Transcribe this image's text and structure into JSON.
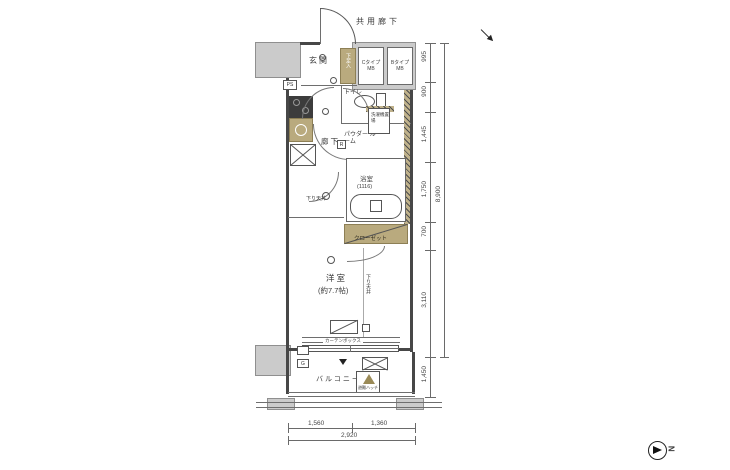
{
  "plan": {
    "labels": {
      "common_corridor": "共用廊下",
      "entrance": "玄関",
      "shoe_cabinet": "下足入",
      "mb_left_line1": "Cタイプ",
      "mb_left_line2": "MB",
      "mb_right_line1": "Bタイプ",
      "mb_right_line2": "MB",
      "toilet": "トイレ",
      "hallway": "廊下",
      "powder_room": "パウダー ルーム",
      "washer_space": "洗濯機置場",
      "bathroom": "浴室",
      "bathroom_module": "(1116)",
      "closet": "クローゼット",
      "western_room": "洋室",
      "western_room_size": "(約7.7帖)",
      "lowered_ceiling_left": "下り天井",
      "lowered_ceiling_right": "下り天井",
      "curtain_box": "カーテンボックス",
      "balcony": "バルコニー",
      "evacuation_hatch": "避難ハッチ",
      "badge_ps": "PS",
      "badge_r": "R",
      "badge_g": "G",
      "compass_north": "N"
    },
    "dims": {
      "right": [
        "995",
        "900",
        "1,445",
        "1,750",
        "700",
        "3,110",
        "1,450"
      ],
      "right_total": "8,900",
      "bottom": [
        "1,560",
        "1,360"
      ],
      "bottom_total": "2,920"
    },
    "colors": {
      "wall_fill": "#cbcbcb",
      "fixture_tan": "#b9aa7e",
      "line": "#474747"
    }
  }
}
